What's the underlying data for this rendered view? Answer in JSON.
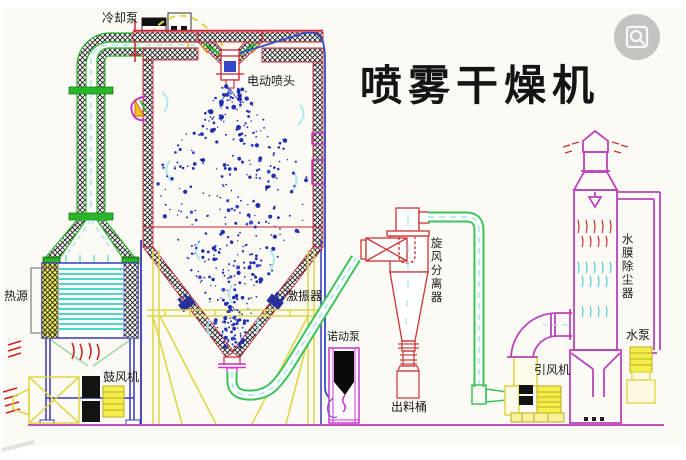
{
  "title": "喷雾干燥机",
  "labels": {
    "cooling_pump": "冷却泵",
    "spray_head": "电动喷头",
    "heat_source": "热源",
    "blower": "鼓风机",
    "vibrator": "激振器",
    "peristaltic_pump": "诺动泵",
    "discharge_barrel": "出料桶",
    "cyclone_separator": "旋风分离器",
    "induced_draft_fan": "引风机",
    "dust_remover": "水膜除尘器",
    "water_pump": "水泵"
  },
  "icons": {
    "watermark": "image-search-icon"
  },
  "colors": {
    "green": "#2ab52a",
    "red": "#cc2233",
    "redl": "#cc3333",
    "mag": "#bb44bb",
    "mag2": "#cc33cc",
    "yel": "#e0d440",
    "yelf": "#f2ef4a",
    "cyan": "#49d8c8",
    "cyanl": "#a6e6ef",
    "navy": "#3838b8",
    "blue": "#3050c8",
    "pblue": "#1f2fae",
    "ground": "#c050c0",
    "ink": "#1a1a1a"
  }
}
